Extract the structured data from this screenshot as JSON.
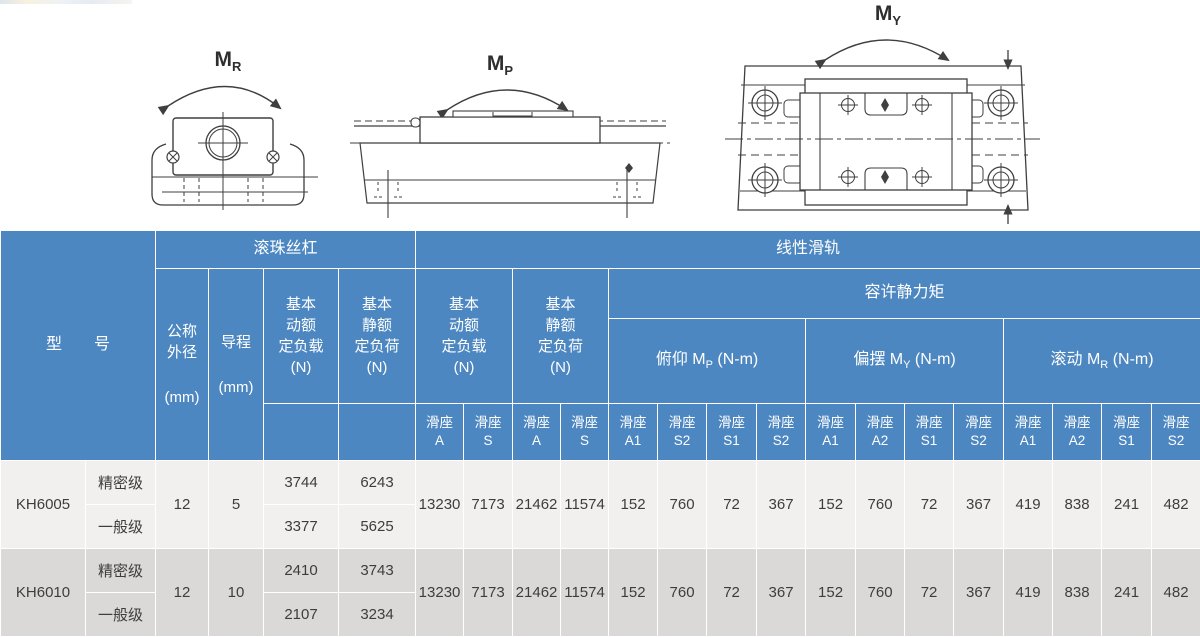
{
  "diagrams": {
    "roll": {
      "main": "M",
      "sub": "R"
    },
    "pitch": {
      "main": "M",
      "sub": "P"
    },
    "yaw": {
      "main": "M",
      "sub": "Y"
    }
  },
  "table": {
    "colors": {
      "header_bg": "#4d87c1",
      "header_text": "#ffffff",
      "row_light": "#f1f0ee",
      "row_dark": "#dad9d7",
      "data_text": "#3d3d3d"
    },
    "header": {
      "model_label": "型　　号",
      "ball_screw": "滚珠丝杠",
      "linear_rail": "线性滑轨",
      "nominal_od": {
        "label": "公称\n外径",
        "unit": "(mm)"
      },
      "lead": {
        "label": "导程",
        "unit": "(mm)"
      },
      "bs_dynamic": "基本\n动额\n定负载\n(N)",
      "bs_static": "基本\n静额\n定负荷\n(N)",
      "lg_dynamic": "基本\n动额\n定负载\n(N)",
      "lg_static": "基本\n静额\n定负荷\n(N)",
      "static_moment": "容许静力矩",
      "pitch": {
        "prefix": "俯仰 M",
        "sub": "P",
        "suffix": " (N-m)"
      },
      "yaw": {
        "prefix": "偏摆 M",
        "sub": "Y",
        "suffix": " (N-m)"
      },
      "roll": {
        "prefix": "滚动 M",
        "sub": "R",
        "suffix": " (N-m)"
      },
      "carriages": [
        "滑座\nA",
        "滑座\nS",
        "滑座\nA",
        "滑座\nS",
        "滑座\nA1",
        "滑座\nS2",
        "滑座\nS1",
        "滑座\nS2",
        "滑座\nA1",
        "滑座\nA2",
        "滑座\nS1",
        "滑座\nS2",
        "滑座\nA1",
        "滑座\nA2",
        "滑座\nS1",
        "滑座\nS2"
      ]
    },
    "rows": [
      {
        "model": "KH6005",
        "od": "12",
        "lead": "5",
        "grades": [
          {
            "name": "精密级",
            "bs_dyn": "3744",
            "bs_stat": "6243"
          },
          {
            "name": "一般级",
            "bs_dyn": "3377",
            "bs_stat": "5625"
          }
        ],
        "lg": [
          "13230",
          "7173",
          "21462",
          "11574"
        ],
        "moments": [
          "152",
          "760",
          "72",
          "367",
          "152",
          "760",
          "72",
          "367",
          "419",
          "838",
          "241",
          "482"
        ]
      },
      {
        "model": "KH6010",
        "od": "12",
        "lead": "10",
        "grades": [
          {
            "name": "精密级",
            "bs_dyn": "2410",
            "bs_stat": "3743"
          },
          {
            "name": "一般级",
            "bs_dyn": "2107",
            "bs_stat": "3234"
          }
        ],
        "lg": [
          "13230",
          "7173",
          "21462",
          "11574"
        ],
        "moments": [
          "152",
          "760",
          "72",
          "367",
          "152",
          "760",
          "72",
          "367",
          "419",
          "838",
          "241",
          "482"
        ]
      }
    ]
  }
}
